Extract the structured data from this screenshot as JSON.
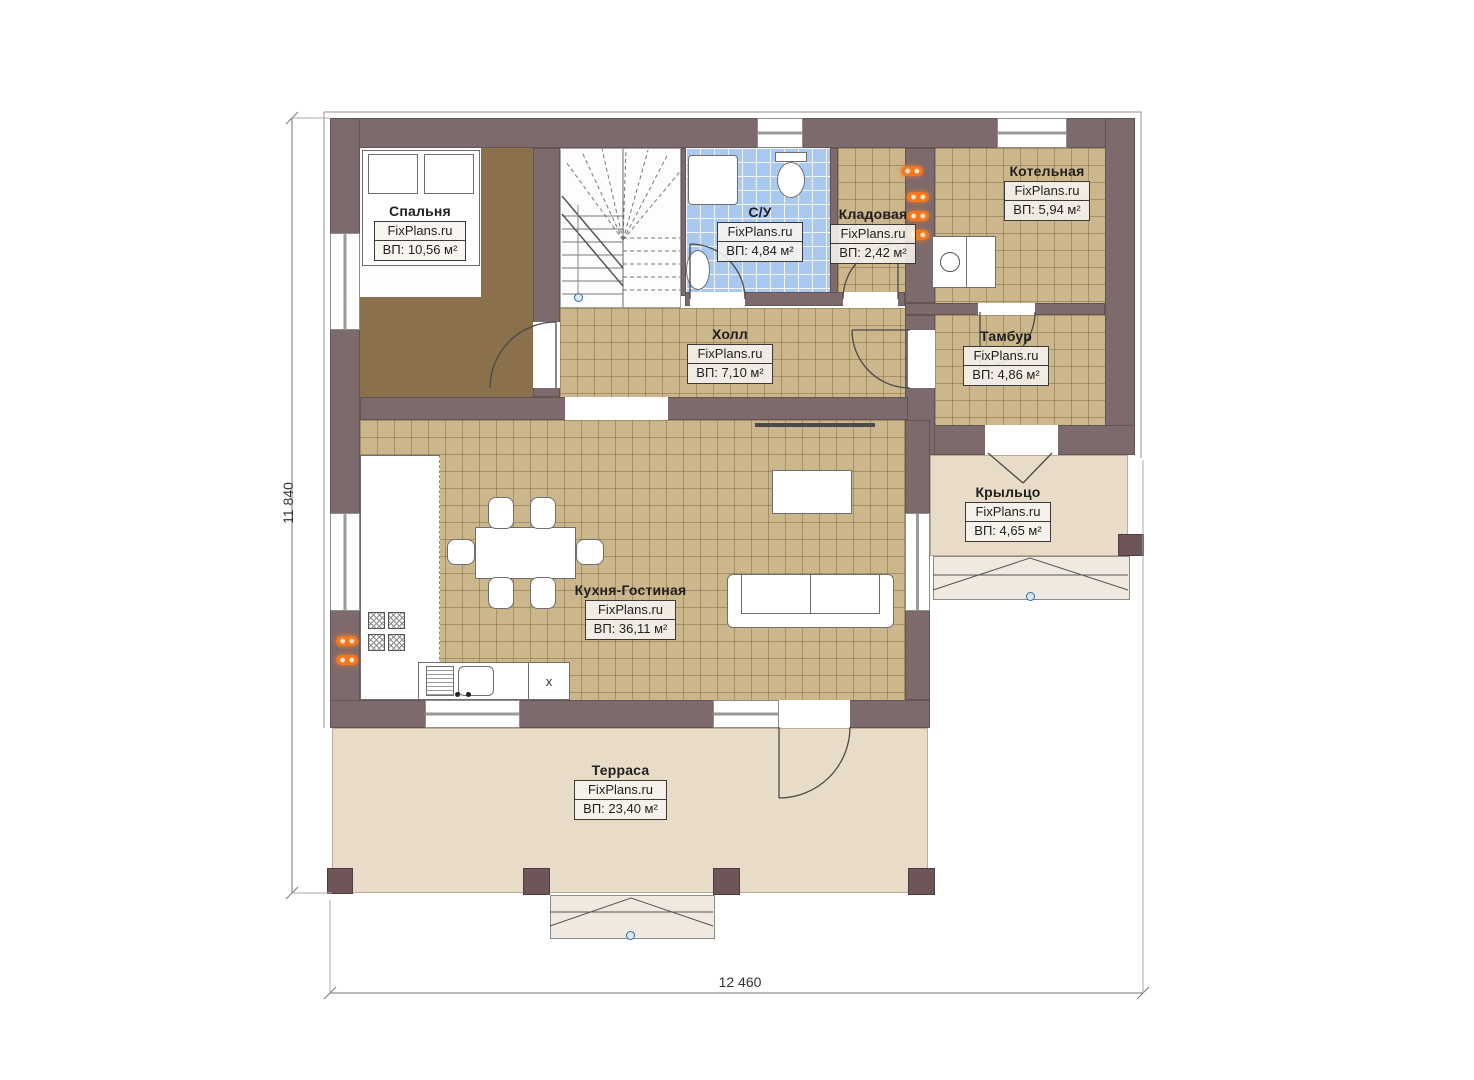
{
  "brand": "FixPlans.ru",
  "dimensions": {
    "height_label": "11 840",
    "width_label": "12 460"
  },
  "rooms": [
    {
      "id": "bedroom",
      "name": "Спальня",
      "area": "ВП: 10,56 м²"
    },
    {
      "id": "bathroom",
      "name": "С/У",
      "area": "ВП: 4,84 м²"
    },
    {
      "id": "storage",
      "name": "Кладовая",
      "area": "ВП: 2,42 м²"
    },
    {
      "id": "boiler_room",
      "name": "Котельная",
      "area": "ВП: 5,94 м²"
    },
    {
      "id": "hall",
      "name": "Холл",
      "area": "ВП: 7,10 м²"
    },
    {
      "id": "vestibule",
      "name": "Тамбур",
      "area": "ВП: 4,86 м²"
    },
    {
      "id": "porch",
      "name": "Крыльцо",
      "area": "ВП: 4,65 м²"
    },
    {
      "id": "kitchen_living",
      "name": "Кухня-Гостиная",
      "area": "ВП: 36,11 м²"
    },
    {
      "id": "terrace",
      "name": "Терраса",
      "area": "ВП: 23,40 м²"
    }
  ],
  "kitchen": {
    "x_cabinet_label": "х"
  },
  "colors": {
    "wall": "#7d6a6c",
    "pillar": "#6e5557",
    "floor_tile": "#ccb68b",
    "floor_bedroom": "#8a714b",
    "floor_bathroom": "#a9c9f0",
    "floor_terrace": "#e8dcc8",
    "radiator_accent": "#f2791f",
    "marker_blue": "#2e6da4"
  }
}
